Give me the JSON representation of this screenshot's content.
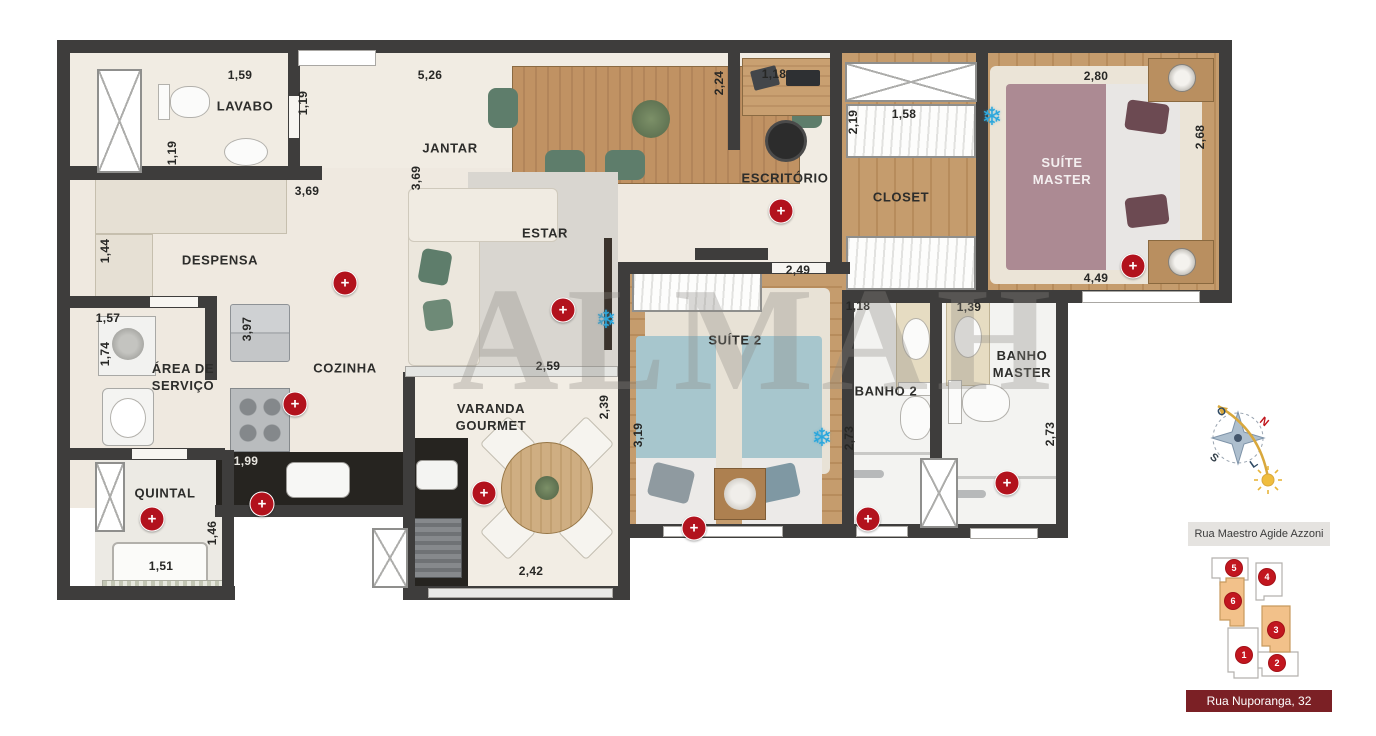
{
  "plan": {
    "watermark": "ALMAH",
    "rooms": {
      "lavabo": "LAVABO",
      "despensa": "DESPENSA",
      "jantar": "JANTAR",
      "estar": "ESTAR",
      "escritorio": "ESCRITÓRIO",
      "closet": "CLOSET",
      "suite_master": "SUÍTE MASTER",
      "area_servico": "ÁREA DE SERVIÇO",
      "cozinha": "COZINHA",
      "varanda": "VARANDA GOURMET",
      "suite2": "SUÍTE 2",
      "banho2": "BANHO 2",
      "banho_master": "BANHO MASTER",
      "quintal": "QUINTAL"
    },
    "dims": [
      "1,59",
      "1,19",
      "1,19",
      "5,26",
      "3,69",
      "3,69",
      "1,44",
      "2,24",
      "1,18",
      "2,19",
      "1,58",
      "2,80",
      "2,68",
      "2,49",
      "4,49",
      "1,57",
      "1,74",
      "3,97",
      "2,59",
      "2,39",
      "1,18",
      "1,39",
      "3,19",
      "2,73",
      "2,73",
      "1,99",
      "1,46",
      "1,51",
      "2,42"
    ],
    "icons": {
      "marker_plus": "+",
      "ac_snowflake": "❄"
    },
    "colors": {
      "marker_red": "#b2121d",
      "ac_blue": "#2ba7dd",
      "wall": "#3e3d3c",
      "highlight_orange": "#f2c18a"
    }
  },
  "compass": {
    "north": "N",
    "south": "S",
    "west": "O",
    "east": "L"
  },
  "keyplan": {
    "street_top": "Rua Maestro Agide Azzoni",
    "street_bottom": "Rua Nuporanga, 32",
    "units": [
      "1",
      "2",
      "3",
      "4",
      "5",
      "6"
    ],
    "highlighted_units": "3, 6"
  }
}
